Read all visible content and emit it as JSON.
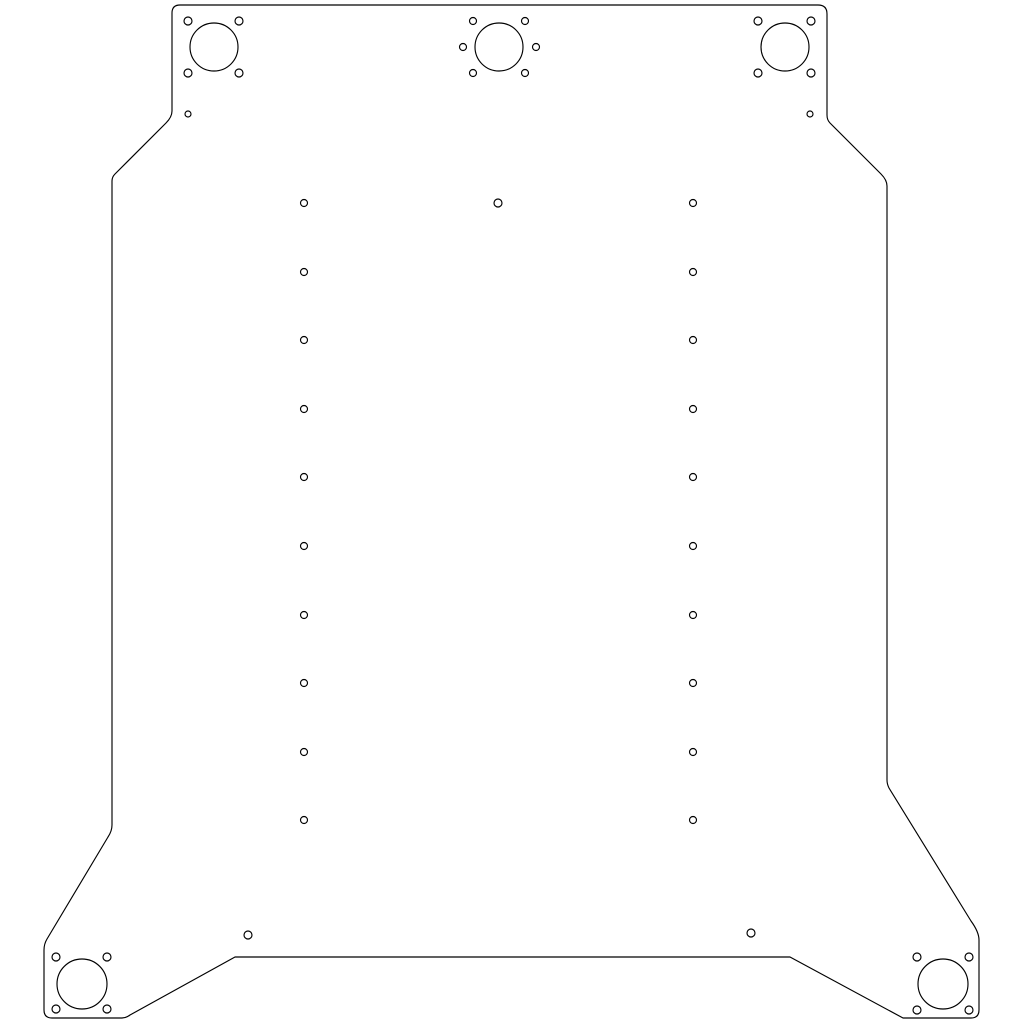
{
  "canvas": {
    "width": 1024,
    "height": 1024,
    "background_color": "#ffffff",
    "line_color": "#000000",
    "line_width": 1.15
  },
  "drawing": {
    "description": "laser-cut plate outline with motor mounts and hole grid",
    "outline_path": "M 180,5 L 818,5 Q 827,5 827,14 L 827,115 Q 827,120 830,123 L 881,174 Q 887,180 887,186 L 887,780 Q 887,784 889,788 L 971,921 Q 979,932 979,940 L 979,1010 Q 979,1018 971,1018 L 903,1018 L 790,957 L 235,957 L 130,1015 Q 126,1018 122,1018 L 52,1018 Q 44,1018 44,1010 L 44,950 Q 44,944 47,939 L 108,837 Q 112,831 112,825 L 112,181 Q 112,177 115,174 L 166,123 Q 172,117 172,111 L 172,13 Q 172,5 180,5 Z",
    "pilot_holes": [
      {
        "name": "pilot-hole-top-left",
        "cx": 214,
        "cy": 47,
        "r": 24
      },
      {
        "name": "pilot-hole-top-center",
        "cx": 499,
        "cy": 47,
        "r": 24
      },
      {
        "name": "pilot-hole-top-right",
        "cx": 785,
        "cy": 47,
        "r": 24
      },
      {
        "name": "pilot-hole-bottom-left",
        "cx": 82,
        "cy": 984,
        "r": 25
      },
      {
        "name": "pilot-hole-bottom-right",
        "cx": 943,
        "cy": 984,
        "r": 25
      }
    ],
    "bolt_holes": [
      {
        "name": "bolt-hole-top-left-1",
        "cx": 188,
        "cy": 21,
        "r": 4
      },
      {
        "name": "bolt-hole-top-left-2",
        "cx": 239,
        "cy": 21,
        "r": 4
      },
      {
        "name": "bolt-hole-top-left-3",
        "cx": 188,
        "cy": 73,
        "r": 4
      },
      {
        "name": "bolt-hole-top-left-4",
        "cx": 239,
        "cy": 73,
        "r": 4
      },
      {
        "name": "bolt-hole-top-center-1",
        "cx": 473,
        "cy": 21,
        "r": 3.5
      },
      {
        "name": "bolt-hole-top-center-2",
        "cx": 525,
        "cy": 21,
        "r": 3.5
      },
      {
        "name": "bolt-hole-top-center-3",
        "cx": 463,
        "cy": 47,
        "r": 3.5
      },
      {
        "name": "bolt-hole-top-center-4",
        "cx": 536,
        "cy": 47,
        "r": 3.5
      },
      {
        "name": "bolt-hole-top-center-5",
        "cx": 473,
        "cy": 73,
        "r": 3.5
      },
      {
        "name": "bolt-hole-top-center-6",
        "cx": 525,
        "cy": 73,
        "r": 3.5
      },
      {
        "name": "bolt-hole-top-right-1",
        "cx": 758,
        "cy": 21,
        "r": 4
      },
      {
        "name": "bolt-hole-top-right-2",
        "cx": 811,
        "cy": 21,
        "r": 4
      },
      {
        "name": "bolt-hole-top-right-3",
        "cx": 758,
        "cy": 73,
        "r": 4
      },
      {
        "name": "bolt-hole-top-right-4",
        "cx": 811,
        "cy": 73,
        "r": 4
      },
      {
        "name": "bolt-hole-bottom-left-1",
        "cx": 56,
        "cy": 957,
        "r": 4
      },
      {
        "name": "bolt-hole-bottom-left-2",
        "cx": 107,
        "cy": 957,
        "r": 4
      },
      {
        "name": "bolt-hole-bottom-left-3",
        "cx": 56,
        "cy": 1009,
        "r": 4
      },
      {
        "name": "bolt-hole-bottom-left-4",
        "cx": 107,
        "cy": 1009,
        "r": 4
      },
      {
        "name": "bolt-hole-bottom-right-1",
        "cx": 917,
        "cy": 957,
        "r": 4
      },
      {
        "name": "bolt-hole-bottom-right-2",
        "cx": 969,
        "cy": 957,
        "r": 4
      },
      {
        "name": "bolt-hole-bottom-right-3",
        "cx": 917,
        "cy": 1010,
        "r": 4
      },
      {
        "name": "bolt-hole-bottom-right-4",
        "cx": 969,
        "cy": 1010,
        "r": 4
      }
    ],
    "small_holes": [
      {
        "name": "small-hole-below-top-left-mount",
        "cx": 188,
        "cy": 114,
        "r": 3
      },
      {
        "name": "small-hole-below-top-right-mount",
        "cx": 810,
        "cy": 114,
        "r": 3
      },
      {
        "name": "small-hole-top-center",
        "cx": 498,
        "cy": 203,
        "r": 4
      },
      {
        "name": "small-hole-bottom-left-foot",
        "cx": 248,
        "cy": 935,
        "r": 4
      },
      {
        "name": "small-hole-bottom-right-foot",
        "cx": 751,
        "cy": 933,
        "r": 4
      }
    ],
    "hole_grid": {
      "column_x": [
        304,
        693
      ],
      "row_y": [
        203,
        272,
        340,
        409,
        477,
        546,
        615,
        683,
        752,
        820
      ],
      "radius": 3.5
    }
  }
}
